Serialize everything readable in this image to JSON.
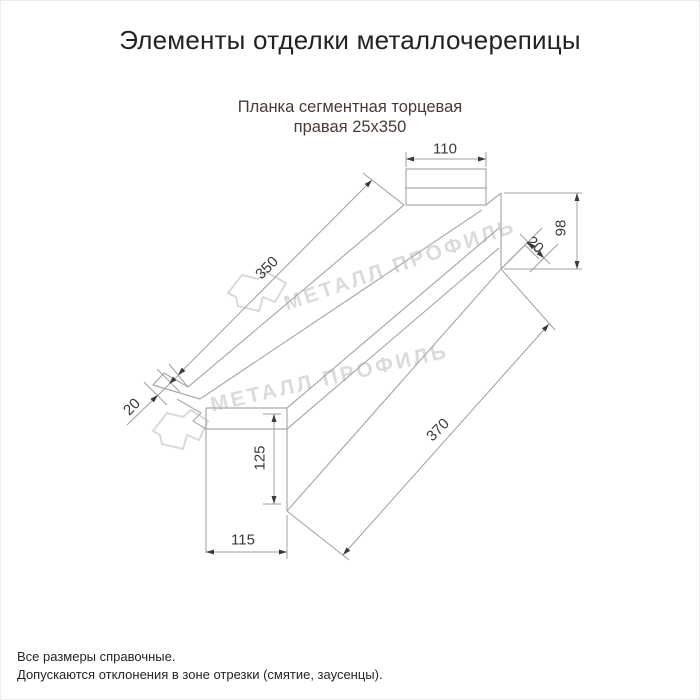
{
  "page": {
    "title": "Элементы отделки металлочерепицы"
  },
  "product": {
    "subtitle_line1": "Планка сегментная торцевая",
    "subtitle_line2": "правая 25х350"
  },
  "drawing": {
    "type": "technical-drawing",
    "units": "mm",
    "dimensions": {
      "top_flange_width": "110",
      "right_end_height": "98",
      "right_fold": "20",
      "length_top": "350",
      "left_fold": "20",
      "left_end_height": "125",
      "length_bottom": "370",
      "bottom_flange_width": "115"
    },
    "watermark_text": "МЕТАЛЛ ПРОФИЛЬ"
  },
  "footer": {
    "note1": "Все размеры справочные.",
    "note2": "Допускаются отклонения в зоне отрезки (смятие, заусенцы)."
  },
  "colors": {
    "subtitle": "#4a3a34",
    "drawing_line": "#ababab",
    "dimension_text": "#3a3a3a",
    "watermark": "#d6d6d6"
  }
}
